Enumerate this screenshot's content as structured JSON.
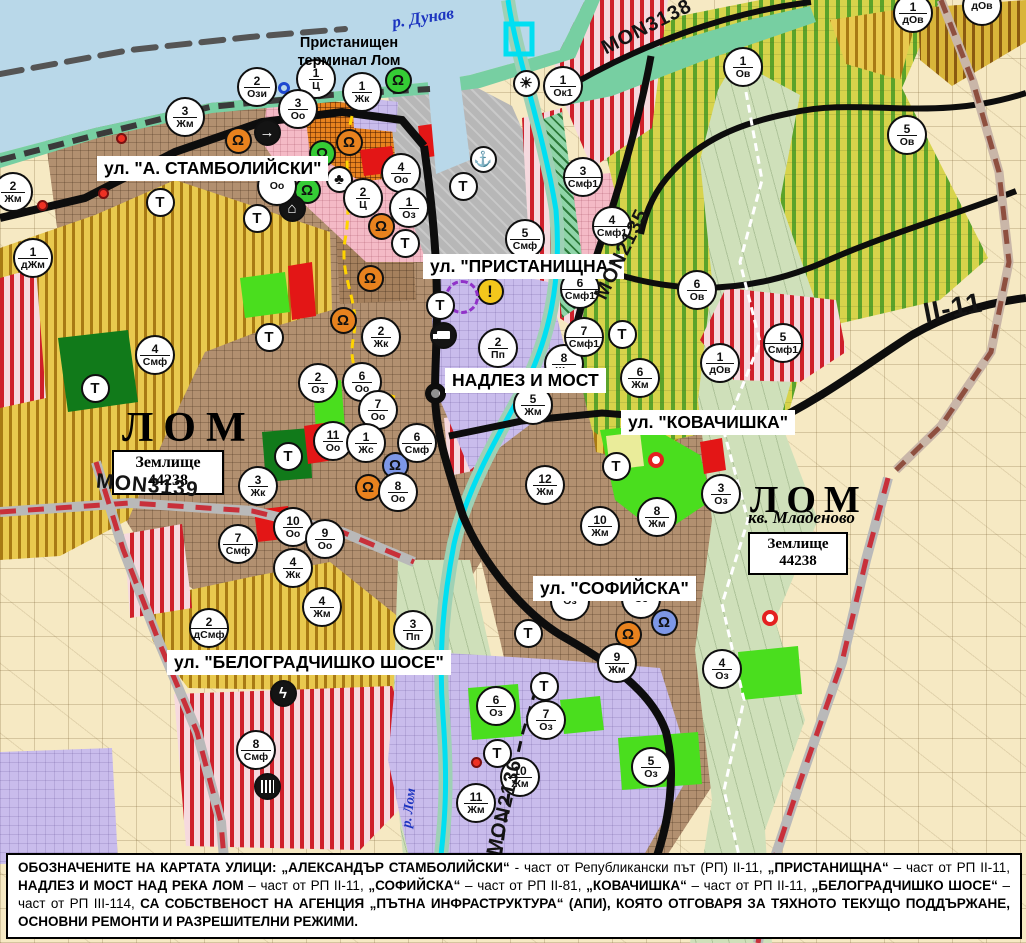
{
  "map": {
    "water_labels": {
      "danube": "р. Дунав",
      "lom_river": "р. Лом"
    },
    "town": {
      "port_terminal": "Пристанищен терминал Лом",
      "name_left": "ЛОМ",
      "name_right": "ЛОМ",
      "district_right": "кв. Младеново",
      "landplot_label": "Землище",
      "landplot_number": "44238"
    },
    "street_labels": {
      "stamboliyski": "ул. \"А. СТАМБОЛИЙСКИ\"",
      "pristanishtna": "ул. \"ПРИСТАНИЩНА\"",
      "nadlez": "НАДЛЕЗ И МОСТ",
      "kovachishka": "ул. \"КОВАЧИШКА\"",
      "sofiyska": "ул. \"СОФИЙСКА\"",
      "belogradchishko": "ул. \"БЕЛОГРАДЧИШКО ШОСЕ\""
    },
    "road_labels": {
      "mon3139": "MON3139",
      "mon3138": "MON3138",
      "mon2135": "MON2135",
      "mon2136": "MON2136",
      "ii11": "II-11"
    }
  },
  "t_label": "Т",
  "zone_markers": [
    {
      "n": "2",
      "c": "Ози",
      "x": 257,
      "y": 87
    },
    {
      "n": "1",
      "c": "Ц",
      "x": 316,
      "y": 79
    },
    {
      "n": "3",
      "c": "Оо",
      "x": 298,
      "y": 109
    },
    {
      "n": "1",
      "c": "Жк",
      "x": 362,
      "y": 92
    },
    {
      "n": "3",
      "c": "Жм",
      "x": 185,
      "y": 117
    },
    {
      "n": "2",
      "c": "Жм",
      "x": 13,
      "y": 192
    },
    {
      "n": "1",
      "c": "дЖм",
      "x": 33,
      "y": 258
    },
    {
      "n": "4",
      "c": "Смф",
      "x": 155,
      "y": 355
    },
    {
      "n": "",
      "c": "Оо",
      "x": 277,
      "y": 186
    },
    {
      "n": "4",
      "c": "Оо",
      "x": 401,
      "y": 173
    },
    {
      "n": "2",
      "c": "Ц",
      "x": 363,
      "y": 198
    },
    {
      "n": "1",
      "c": "Оз",
      "x": 409,
      "y": 208
    },
    {
      "n": "2",
      "c": "Жк",
      "x": 381,
      "y": 337
    },
    {
      "n": "6",
      "c": "Оо",
      "x": 362,
      "y": 382
    },
    {
      "n": "2",
      "c": "Оз",
      "x": 318,
      "y": 383
    },
    {
      "n": "7",
      "c": "Оо",
      "x": 378,
      "y": 410
    },
    {
      "n": "11",
      "c": "Оо",
      "x": 333,
      "y": 441
    },
    {
      "n": "1",
      "c": "Жс",
      "x": 366,
      "y": 443
    },
    {
      "n": "6",
      "c": "Смф",
      "x": 417,
      "y": 443
    },
    {
      "n": "8",
      "c": "Оо",
      "x": 398,
      "y": 492
    },
    {
      "n": "3",
      "c": "Жк",
      "x": 258,
      "y": 486
    },
    {
      "n": "10",
      "c": "Оо",
      "x": 293,
      "y": 527
    },
    {
      "n": "9",
      "c": "Оо",
      "x": 325,
      "y": 539
    },
    {
      "n": "7",
      "c": "Смф",
      "x": 238,
      "y": 544
    },
    {
      "n": "4",
      "c": "Жк",
      "x": 293,
      "y": 568
    },
    {
      "n": "4",
      "c": "Жм",
      "x": 322,
      "y": 607
    },
    {
      "n": "2",
      "c": "дСмф",
      "x": 209,
      "y": 628
    },
    {
      "n": "3",
      "c": "Пп",
      "x": 413,
      "y": 630
    },
    {
      "n": "8",
      "c": "Смф",
      "x": 256,
      "y": 750
    },
    {
      "n": "5",
      "c": "Смф",
      "x": 525,
      "y": 239
    },
    {
      "n": "2",
      "c": "Пп",
      "x": 498,
      "y": 348
    },
    {
      "n": "8",
      "c": "Жм",
      "x": 564,
      "y": 364
    },
    {
      "n": "5",
      "c": "Жм",
      "x": 533,
      "y": 405
    },
    {
      "n": "12",
      "c": "Жм",
      "x": 545,
      "y": 485
    },
    {
      "n": "6",
      "c": "Жм",
      "x": 640,
      "y": 378
    },
    {
      "n": "8",
      "c": "Жм",
      "x": 657,
      "y": 517
    },
    {
      "n": "10",
      "c": "Жм",
      "x": 600,
      "y": 526
    },
    {
      "n": "3",
      "c": "Оз",
      "x": 721,
      "y": 494
    },
    {
      "n": "9",
      "c": "Жм",
      "x": 617,
      "y": 663
    },
    {
      "n": "4",
      "c": "Оз",
      "x": 722,
      "y": 669
    },
    {
      "n": "6",
      "c": "Оз",
      "x": 496,
      "y": 706
    },
    {
      "n": "7",
      "c": "Оз",
      "x": 546,
      "y": 720
    },
    {
      "n": "5",
      "c": "Оз",
      "x": 651,
      "y": 767
    },
    {
      "n": "10",
      "c": "Жм",
      "x": 520,
      "y": 777
    },
    {
      "n": "11",
      "c": "Жм",
      "x": 476,
      "y": 803
    },
    {
      "n": "3",
      "c": "Смф1",
      "x": 583,
      "y": 177
    },
    {
      "n": "4",
      "c": "Смф1",
      "x": 612,
      "y": 226
    },
    {
      "n": "6",
      "c": "Смф1",
      "x": 580,
      "y": 289
    },
    {
      "n": "7",
      "c": "Смф1",
      "x": 584,
      "y": 337
    },
    {
      "n": "5",
      "c": "Смф1",
      "x": 783,
      "y": 343
    },
    {
      "n": "1",
      "c": "дОв",
      "x": 720,
      "y": 363
    },
    {
      "n": "6",
      "c": "Ов",
      "x": 697,
      "y": 290
    },
    {
      "n": "1",
      "c": "Ов",
      "x": 743,
      "y": 67
    },
    {
      "n": "5",
      "c": "Ов",
      "x": 907,
      "y": 135
    },
    {
      "n": "1",
      "c": "дОв",
      "x": 913,
      "y": 13
    },
    {
      "n": "",
      "c": "дОв",
      "x": 982,
      "y": 6
    },
    {
      "n": "1",
      "c": "Ок1",
      "x": 563,
      "y": 86
    },
    {
      "n": "",
      "c": "Оз",
      "x": 570,
      "y": 601
    },
    {
      "n": "",
      "c": "Оз",
      "x": 641,
      "y": 599
    }
  ],
  "t_markers": [
    [
      160,
      202
    ],
    [
      257,
      218
    ],
    [
      405,
      243
    ],
    [
      463,
      186
    ],
    [
      440,
      305
    ],
    [
      269,
      337
    ],
    [
      288,
      456
    ],
    [
      622,
      334
    ],
    [
      616,
      466
    ],
    [
      95,
      388
    ],
    [
      528,
      633
    ],
    [
      544,
      686
    ],
    [
      497,
      753
    ]
  ],
  "icons": [
    {
      "name": "cultural-monument-icon",
      "cls": "or",
      "g": "Ω",
      "x": 238,
      "y": 140
    },
    {
      "name": "cultural-monument-icon",
      "cls": "or",
      "g": "Ω",
      "x": 349,
      "y": 142
    },
    {
      "name": "cultural-monument-icon",
      "cls": "or",
      "g": "Ω",
      "x": 381,
      "y": 226
    },
    {
      "name": "cultural-monument-icon",
      "cls": "or",
      "g": "Ω",
      "x": 370,
      "y": 278
    },
    {
      "name": "cultural-monument-icon",
      "cls": "or",
      "g": "Ω",
      "x": 343,
      "y": 320
    },
    {
      "name": "cultural-monument-icon",
      "cls": "or",
      "g": "Ω",
      "x": 368,
      "y": 487
    },
    {
      "name": "cultural-monument-icon",
      "cls": "or",
      "g": "Ω",
      "x": 628,
      "y": 634
    },
    {
      "name": "cultural-site-icon",
      "cls": "gr",
      "g": "Ω",
      "x": 398,
      "y": 80
    },
    {
      "name": "cultural-site-icon",
      "cls": "gr",
      "g": "Ω",
      "x": 322,
      "y": 153
    },
    {
      "name": "cultural-site-icon",
      "cls": "gr",
      "g": "Ω",
      "x": 307,
      "y": 190
    },
    {
      "name": "museum-icon",
      "cls": "bl",
      "g": "Ω",
      "x": 395,
      "y": 465
    },
    {
      "name": "museum-icon",
      "cls": "bl",
      "g": "Ω",
      "x": 664,
      "y": 622
    },
    {
      "name": "trefoil-icon",
      "cls": "wh",
      "g": "♣",
      "x": 339,
      "y": 179
    },
    {
      "name": "roundabout-arrow-icon",
      "cls": "bk",
      "g": "→",
      "x": 267,
      "y": 132
    },
    {
      "name": "tunnel-icon",
      "cls": "bk",
      "g": "⌂",
      "x": 292,
      "y": 208
    },
    {
      "name": "port-anchor-icon",
      "cls": "wh",
      "g": "⚓",
      "x": 483,
      "y": 159
    },
    {
      "name": "sun-mound-icon",
      "cls": "wh",
      "g": "☀",
      "x": 526,
      "y": 83
    },
    {
      "name": "warning-icon",
      "cls": "warn",
      "g": "!",
      "x": 490,
      "y": 291
    },
    {
      "name": "truck-terminal-icon",
      "cls": "bk truck",
      "g": "",
      "x": 443,
      "y": 335
    },
    {
      "name": "power-substation-icon",
      "cls": "bk",
      "g": "ϟ",
      "x": 283,
      "y": 693
    },
    {
      "name": "railway-crossing-icon",
      "cls": "bk rails",
      "g": "",
      "x": 267,
      "y": 786
    },
    {
      "name": "overpass-ring-icon",
      "cls": "loop",
      "g": "",
      "x": 435,
      "y": 393
    },
    {
      "name": "signal-ring-icon",
      "cls": "redring",
      "g": "",
      "x": 656,
      "y": 460
    },
    {
      "name": "signal-ring-icon",
      "cls": "redring",
      "g": "",
      "x": 770,
      "y": 618
    },
    {
      "name": "signal-dot-icon",
      "cls": "reddot",
      "g": "",
      "x": 121,
      "y": 138
    },
    {
      "name": "signal-dot-icon",
      "cls": "reddot",
      "g": "",
      "x": 103,
      "y": 193
    },
    {
      "name": "signal-dot-icon",
      "cls": "reddot",
      "g": "",
      "x": 42,
      "y": 205
    },
    {
      "name": "signal-dot-icon",
      "cls": "reddot",
      "g": "",
      "x": 476,
      "y": 762
    },
    {
      "name": "blue-ring-icon",
      "cls": "bluering",
      "g": "",
      "x": 284,
      "y": 88
    },
    {
      "name": "heritage-boundary-circle-icon",
      "cls": "purple",
      "g": "",
      "x": 462,
      "y": 297
    }
  ],
  "footer": {
    "segments": [
      {
        "t": "ОБОЗНАЧЕНИТЕ НА КАРТАТА УЛИЦИ: „АЛЕКСАНДЪР СТАМБОЛИЙСКИ“",
        "b": true
      },
      {
        "t": " - част от Републикански път (РП) II-11, ",
        "b": false
      },
      {
        "t": "„ПРИСТАНИЩНА“",
        "b": true
      },
      {
        "t": " – част от РП II-11, ",
        "b": false
      },
      {
        "t": "НАДЛЕЗ И МОСТ НАД РЕКА ЛОМ",
        "b": true
      },
      {
        "t": " – част от РП II-11, ",
        "b": false
      },
      {
        "t": "„СОФИЙСКА“",
        "b": true
      },
      {
        "t": " – част от РП II-81, ",
        "b": false
      },
      {
        "t": "„КОВАЧИШКА“",
        "b": true
      },
      {
        "t": " – част от РП II-11, ",
        "b": false
      },
      {
        "t": "„БЕЛОГРАДЧИШКО ШОСЕ“",
        "b": true
      },
      {
        "t": " – част от РП III-114, ",
        "b": false
      },
      {
        "t": "СА СОБСТВЕНОСТ НА АГЕНЦИЯ „ПЪТНА ИНФРАСТРУКТУРА“ (АПИ), КОЯТО ОТГОВАРЯ ЗА ТЯХНОТО ТЕКУЩО ПОДДЪРЖАНЕ, ОСНОВНИ РЕМОНТИ И РАЗРЕШИТЕЛНИ РЕЖИМИ.",
        "b": true
      }
    ]
  },
  "palette": {
    "water": "#b9d8e9",
    "shore_green": "#77cfa2",
    "urban_brown": "#b29070",
    "agriculture_gold": "#e9c94e",
    "vineyard_green": "#5ba32a",
    "production_red": "#cf1f2a",
    "public_lavender": "#c9bcec",
    "park_green": "#117a1a",
    "greenery_lime": "#4ade1e",
    "cadastral_beige": "#f6e9c3",
    "river_cyan": "#00dff2",
    "road_black": "#0d0d0d",
    "road_dashed_red": "#c8303a",
    "monument_orange": "#e8821e",
    "monument_green": "#35cc35",
    "monument_blue": "#7d97e6",
    "label_blue": "#1d35c0"
  }
}
